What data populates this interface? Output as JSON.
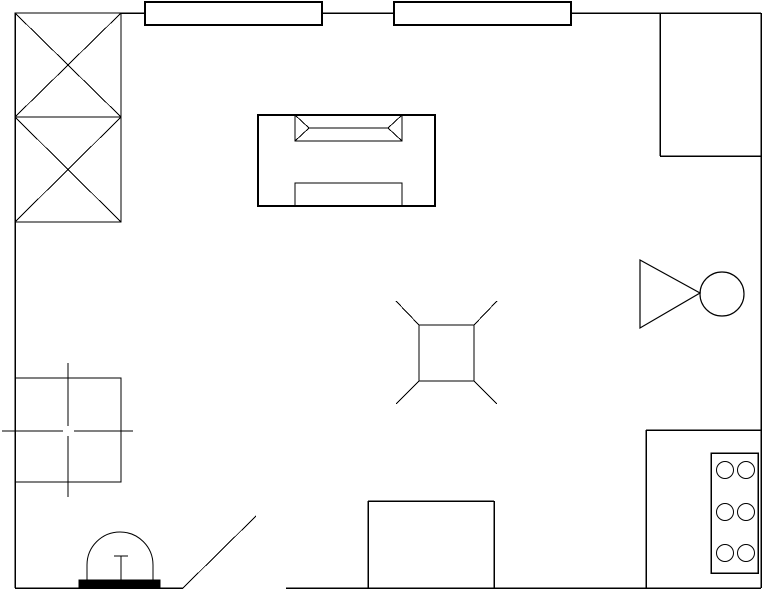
{
  "app": {
    "title": "floor-plan-drawing",
    "background_color": "#ffffff",
    "line_color": "#000000",
    "fill_color": "#000000"
  },
  "canvas": {
    "width": 769,
    "height": 600
  },
  "floor_plan": {
    "elements": [
      {
        "name": "exterior-walls",
        "shapes": [
          {
            "t": "line",
            "x1": 15,
            "y1": 13,
            "x2": 15,
            "y2": 588,
            "sw": 1.5
          },
          {
            "t": "line",
            "x1": 121,
            "y1": 13,
            "x2": 145,
            "y2": 13,
            "sw": 1.5
          },
          {
            "t": "line",
            "x1": 322,
            "y1": 13,
            "x2": 394,
            "y2": 13,
            "sw": 1.5
          },
          {
            "t": "line",
            "x1": 571,
            "y1": 13,
            "x2": 761,
            "y2": 13,
            "sw": 1.5
          },
          {
            "t": "line",
            "x1": 761,
            "y1": 13,
            "x2": 761,
            "y2": 588,
            "sw": 1.5
          },
          {
            "t": "line",
            "x1": 15,
            "y1": 588,
            "x2": 183,
            "y2": 588,
            "sw": 1.5
          },
          {
            "t": "line",
            "x1": 286,
            "y1": 588,
            "x2": 761,
            "y2": 588,
            "sw": 1.5
          }
        ]
      },
      {
        "name": "window-symbol-1",
        "shapes": [
          {
            "t": "rect",
            "x": 145,
            "y": 2,
            "w": 177,
            "h": 23,
            "sw": 2
          }
        ]
      },
      {
        "name": "window-symbol-2",
        "shapes": [
          {
            "t": "rect",
            "x": 394,
            "y": 2,
            "w": 177,
            "h": 23,
            "sw": 2
          }
        ]
      },
      {
        "name": "wardrobe-crossed-boxes",
        "shapes": [
          {
            "t": "rect",
            "x": 15,
            "y": 13,
            "w": 106,
            "h": 209,
            "sw": 1.4
          },
          {
            "t": "line",
            "x1": 15,
            "y1": 117,
            "x2": 121,
            "y2": 117,
            "sw": 1.4
          },
          {
            "t": "line",
            "x1": 15,
            "y1": 13,
            "x2": 121,
            "y2": 117,
            "sw": 1
          },
          {
            "t": "line",
            "x1": 121,
            "y1": 13,
            "x2": 15,
            "y2": 117,
            "sw": 1
          },
          {
            "t": "line",
            "x1": 15,
            "y1": 117,
            "x2": 121,
            "y2": 222,
            "sw": 1
          },
          {
            "t": "line",
            "x1": 121,
            "y1": 117,
            "x2": 15,
            "y2": 222,
            "sw": 1
          }
        ]
      },
      {
        "name": "corner-closet",
        "shapes": [
          {
            "t": "line",
            "x1": 660,
            "y1": 13,
            "x2": 660,
            "y2": 156,
            "sw": 1.5
          },
          {
            "t": "line",
            "x1": 660,
            "y1": 156,
            "x2": 761,
            "y2": 156,
            "sw": 1.5
          }
        ]
      },
      {
        "name": "sofa-symbol",
        "shapes": [
          {
            "t": "rect",
            "x": 258,
            "y": 115,
            "w": 177,
            "h": 91,
            "sw": 1.8
          },
          {
            "t": "rect",
            "x": 295,
            "y": 115,
            "w": 107,
            "h": 26,
            "sw": 1.4
          },
          {
            "t": "line",
            "x1": 295,
            "y1": 115,
            "x2": 309,
            "y2": 128,
            "sw": 1
          },
          {
            "t": "line",
            "x1": 295,
            "y1": 141,
            "x2": 309,
            "y2": 128,
            "sw": 1
          },
          {
            "t": "line",
            "x1": 402,
            "y1": 115,
            "x2": 388,
            "y2": 128,
            "sw": 1
          },
          {
            "t": "line",
            "x1": 402,
            "y1": 141,
            "x2": 388,
            "y2": 128,
            "sw": 1
          },
          {
            "t": "line",
            "x1": 309,
            "y1": 128,
            "x2": 388,
            "y2": 128,
            "sw": 1.2
          },
          {
            "t": "rect",
            "x": 295,
            "y": 183,
            "w": 107,
            "h": 23,
            "sw": 1.4
          }
        ]
      },
      {
        "name": "table-with-chair-legs",
        "shapes": [
          {
            "t": "rect",
            "x": 419,
            "y": 325,
            "w": 55,
            "h": 56,
            "sw": 1.4
          },
          {
            "t": "line",
            "x1": 419,
            "y1": 325,
            "x2": 396,
            "y2": 301,
            "sw": 1
          },
          {
            "t": "line",
            "x1": 474,
            "y1": 325,
            "x2": 497,
            "y2": 301,
            "sw": 1
          },
          {
            "t": "line",
            "x1": 419,
            "y1": 381,
            "x2": 396,
            "y2": 404,
            "sw": 1
          },
          {
            "t": "line",
            "x1": 474,
            "y1": 381,
            "x2": 497,
            "y2": 404,
            "sw": 1
          }
        ]
      },
      {
        "name": "floor-lamp-symbol",
        "shapes": [
          {
            "t": "polygon",
            "pts": "640,260 640,328 700,293",
            "sw": 1.2
          },
          {
            "t": "circle",
            "cx": 722,
            "cy": 294,
            "r": 22,
            "sw": 1.2
          }
        ]
      },
      {
        "name": "square-table-centermark",
        "shapes": [
          {
            "t": "rect",
            "x": 15,
            "y": 378,
            "w": 106,
            "h": 104,
            "sw": 1.4
          },
          {
            "t": "line",
            "x1": 68,
            "y1": 363,
            "x2": 68,
            "y2": 426,
            "sw": 1
          },
          {
            "t": "line",
            "x1": 68,
            "y1": 436,
            "x2": 68,
            "y2": 497,
            "sw": 1
          },
          {
            "t": "line",
            "x1": 2,
            "y1": 431,
            "x2": 63,
            "y2": 431,
            "sw": 1
          },
          {
            "t": "line",
            "x1": 74,
            "y1": 431,
            "x2": 133,
            "y2": 431,
            "sw": 1
          }
        ]
      },
      {
        "name": "door-leaf",
        "shapes": [
          {
            "t": "line",
            "x1": 183,
            "y1": 588,
            "x2": 256,
            "y2": 516,
            "sw": 1
          }
        ]
      },
      {
        "name": "entry-dome-fixture",
        "shapes": [
          {
            "t": "rect",
            "x": 79,
            "y": 580,
            "w": 81,
            "h": 8,
            "sw": 1,
            "fill": "#000000"
          },
          {
            "t": "path",
            "d": "M 87 581 L 87 565 A 33 33 0 0 1 153 565 L 153 581",
            "sw": 1
          },
          {
            "t": "line",
            "x1": 121,
            "y1": 556,
            "x2": 121,
            "y2": 581,
            "sw": 1.4
          },
          {
            "t": "line",
            "x1": 114,
            "y1": 556,
            "x2": 128,
            "y2": 556,
            "sw": 1.4
          }
        ]
      },
      {
        "name": "bottom-cabinet",
        "shapes": [
          {
            "t": "line",
            "x1": 368,
            "y1": 501,
            "x2": 494,
            "y2": 501,
            "sw": 1.5
          },
          {
            "t": "line",
            "x1": 368,
            "y1": 501,
            "x2": 368,
            "y2": 588,
            "sw": 1.5
          },
          {
            "t": "line",
            "x1": 494,
            "y1": 501,
            "x2": 494,
            "y2": 588,
            "sw": 1.5
          }
        ]
      },
      {
        "name": "kitchen-counter",
        "shapes": [
          {
            "t": "line",
            "x1": 646,
            "y1": 430,
            "x2": 761,
            "y2": 430,
            "sw": 1.5
          },
          {
            "t": "line",
            "x1": 646,
            "y1": 430,
            "x2": 646,
            "y2": 588,
            "sw": 1.5
          }
        ]
      },
      {
        "name": "stove-with-burners",
        "shapes": [
          {
            "t": "rect",
            "x": 711,
            "y": 453,
            "w": 47,
            "h": 120,
            "sw": 1.5
          },
          {
            "t": "circle",
            "cx": 725,
            "cy": 470,
            "r": 8.5,
            "sw": 1
          },
          {
            "t": "circle",
            "cx": 746,
            "cy": 470,
            "r": 8.5,
            "sw": 1
          },
          {
            "t": "circle",
            "cx": 725,
            "cy": 512,
            "r": 8.5,
            "sw": 1
          },
          {
            "t": "circle",
            "cx": 746,
            "cy": 512,
            "r": 8.5,
            "sw": 1
          },
          {
            "t": "circle",
            "cx": 725,
            "cy": 553,
            "r": 8.5,
            "sw": 1
          },
          {
            "t": "circle",
            "cx": 746,
            "cy": 553,
            "r": 8.5,
            "sw": 1
          }
        ]
      }
    ]
  }
}
